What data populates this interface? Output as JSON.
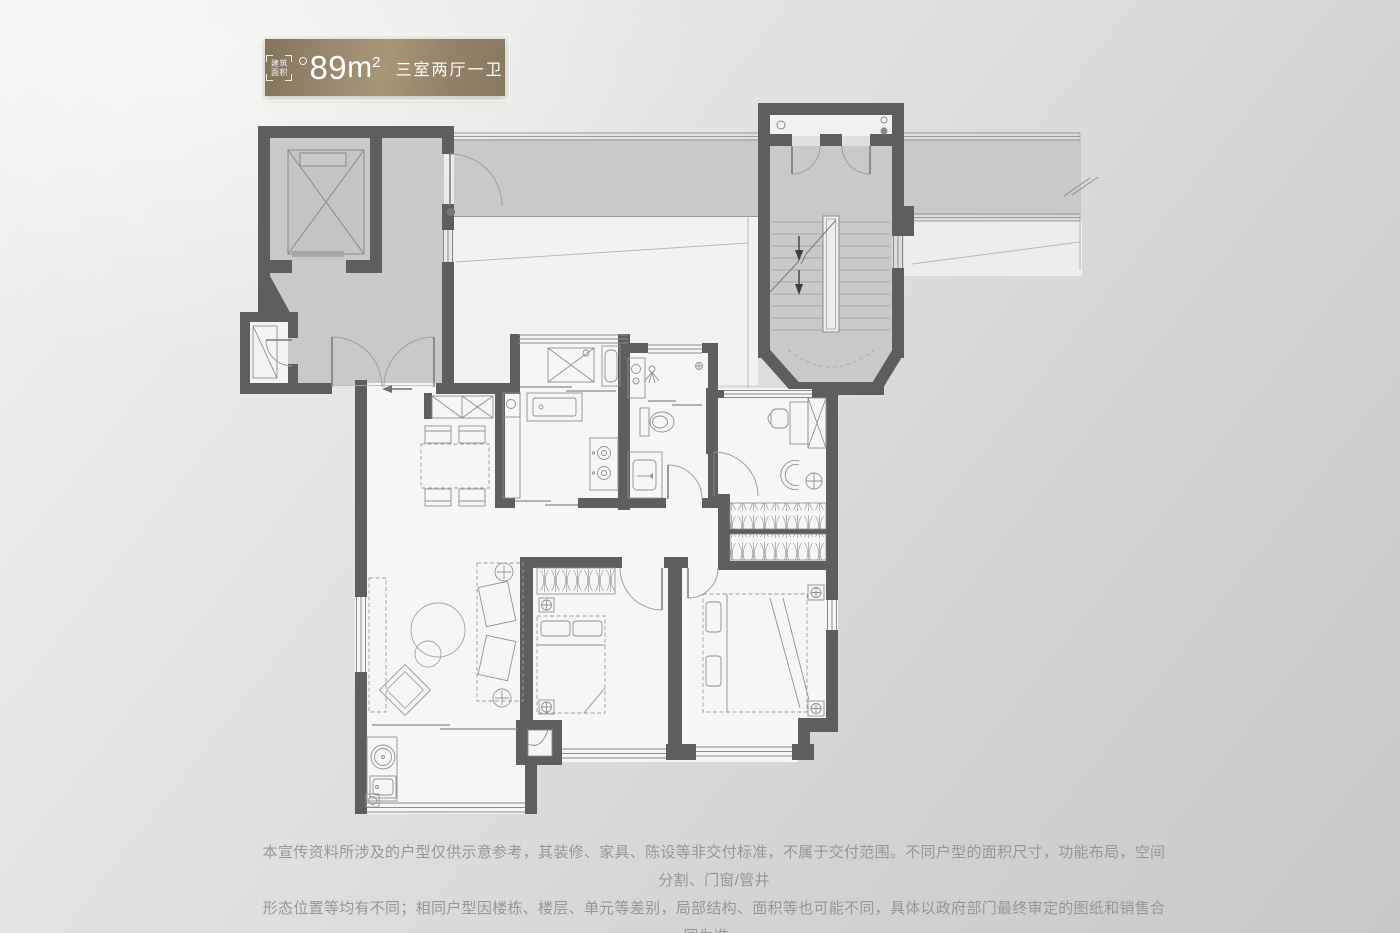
{
  "badge": {
    "area_icon_line1": "建筑",
    "area_icon_line2": "面积",
    "area_value": "89",
    "area_unit_base": "m",
    "area_unit_exponent": "2",
    "layout_label": "三室两厅一卫"
  },
  "disclaimer": {
    "line1": "本宣传资料所涉及的户型仅供示意参考，其装修、家具、陈设等非交付标准，不属于交付范围。不同户型的面积尺寸，功能布局，空间分割、门窗/管井",
    "line2": "形态位置等均有不同；相同户型因楼栋、楼层、单元等差别，局部结构、面积等也可能不同，具体以政府部门最终审定的图纸和销售合同为准。"
  },
  "colors": {
    "badge_gold_dark": "#83735a",
    "badge_gold_light": "#a89678",
    "badge_text": "#ffffff",
    "wall": "#5e5e5e",
    "public_area_fill": "#c9c9c8",
    "unit_floor_fill": "#f6f6f4",
    "plan_line": "#8f8f8f",
    "background_light": "#f1f1ef",
    "background_dark": "#c8c8c6",
    "disclaimer_text": "#97979a"
  }
}
